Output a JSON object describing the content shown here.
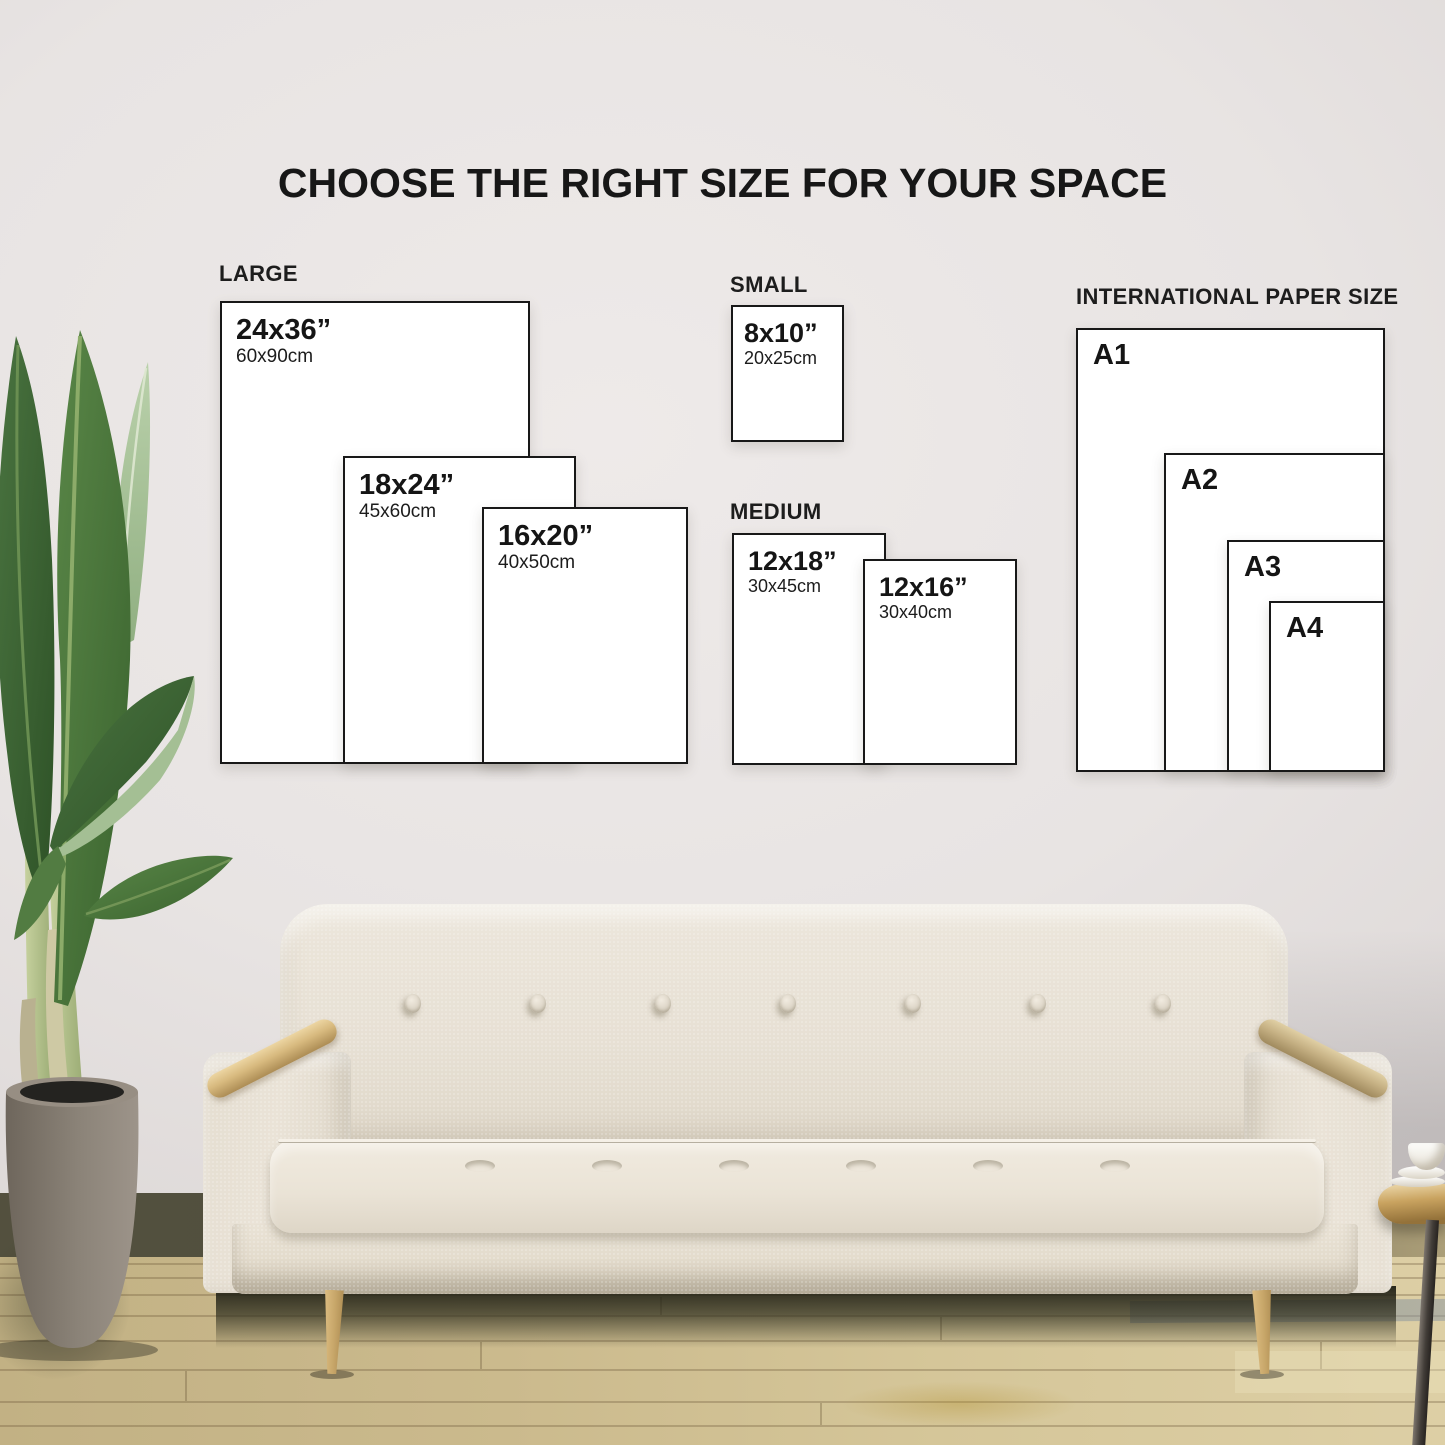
{
  "title": "CHOOSE THE RIGHT SIZE FOR YOUR SPACE",
  "groups": {
    "large": {
      "label": "LARGE",
      "posters": [
        {
          "inches": "24x36”",
          "cm": "60x90cm"
        },
        {
          "inches": "18x24”",
          "cm": "45x60cm"
        },
        {
          "inches": "16x20”",
          "cm": "40x50cm"
        }
      ]
    },
    "small": {
      "label": "SMALL",
      "posters": [
        {
          "inches": "8x10”",
          "cm": "20x25cm"
        }
      ]
    },
    "medium": {
      "label": "MEDIUM",
      "posters": [
        {
          "inches": "12x18”",
          "cm": "30x45cm"
        },
        {
          "inches": "12x16”",
          "cm": "30x40cm"
        }
      ]
    },
    "international": {
      "label": "INTERNATIONAL PAPER SIZE",
      "sizes": [
        "A1",
        "A2",
        "A3",
        "A4"
      ]
    }
  },
  "colors": {
    "poster_border": "#181818",
    "poster_fill": "#ffffff",
    "text": "#1d1d1d",
    "wall": "#e7e3e2",
    "floor": "#d3c397",
    "sofa_fabric": "#e8e1d5",
    "armrest_wood": "#d2b379",
    "leaf_green": "#3f6a35",
    "pot_gray": "#8d857a"
  }
}
